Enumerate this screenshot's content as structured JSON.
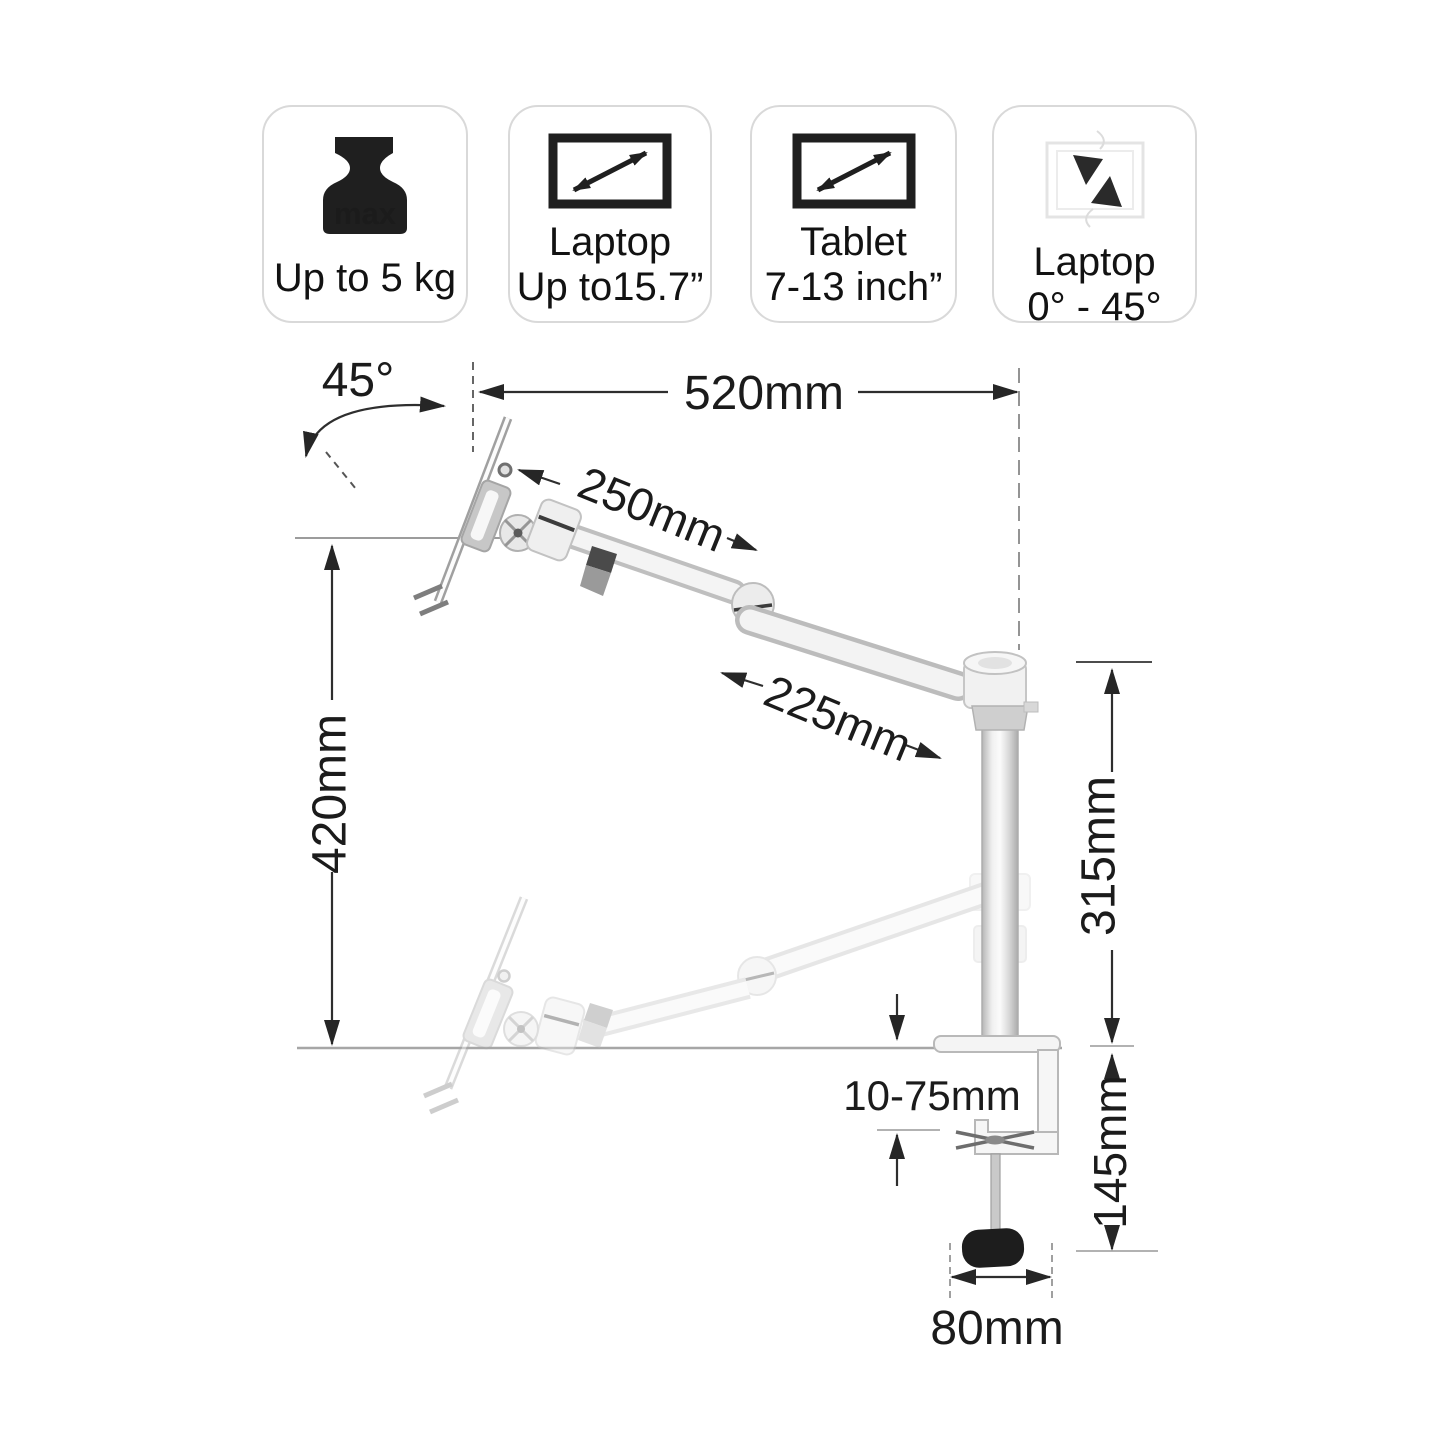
{
  "product_badges": [
    {
      "icon": "weight-max-icon",
      "icon_text": "max",
      "lines": [
        "Up to 5 kg"
      ]
    },
    {
      "icon": "screen-diagonal-icon",
      "lines": [
        "Laptop",
        "Up to15.7”"
      ]
    },
    {
      "icon": "screen-diagonal-icon",
      "lines": [
        "Tablet",
        "7-13 inch”"
      ]
    },
    {
      "icon": "laptop-tilt-icon",
      "lines": [
        "Laptop",
        "0° - 45°"
      ]
    }
  ],
  "diagram_labels": {
    "tilt_angle": "45°",
    "total_reach": "520mm",
    "upper_arm_length": "250mm",
    "lower_arm_length": "225mm",
    "pole_height": "315mm",
    "lift_height": "420mm",
    "desk_thickness_range": "10-75mm",
    "clamp_height": "145mm",
    "clamp_base_width": "80mm"
  },
  "colors": {
    "background": "#ffffff",
    "text": "#1a1a1a",
    "dimension_line": "#2e2e2e",
    "reference_line": "#9c9c9c",
    "metal_edge": "#bdbdbd",
    "metal_fill": "#f3f3f3",
    "knob": "#1d1d1d",
    "badge_border": "#d9d9d9"
  }
}
